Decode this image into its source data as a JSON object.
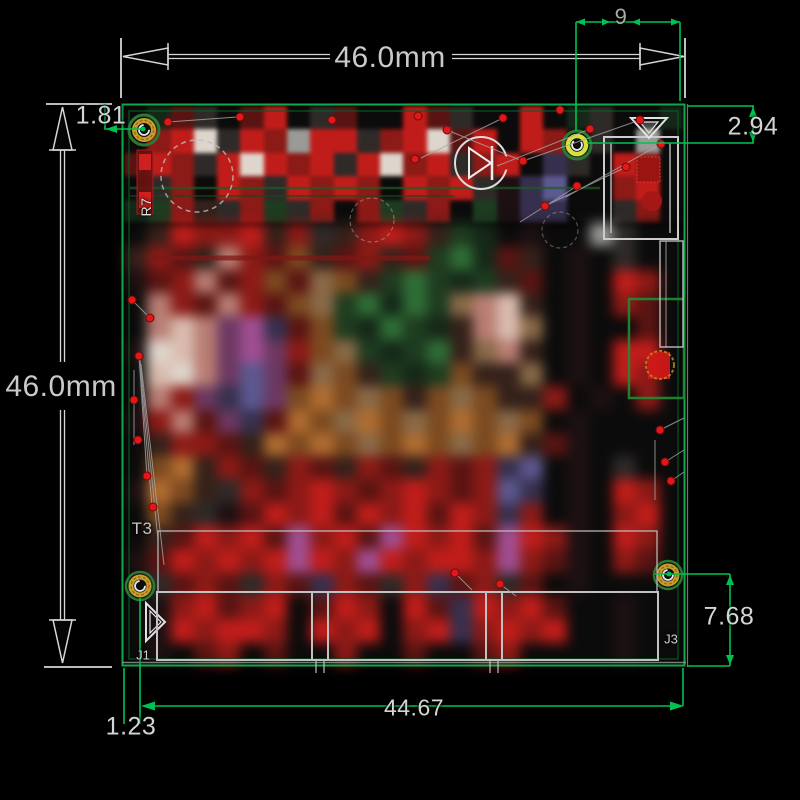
{
  "drawing": {
    "dim_top_width": "46.0mm",
    "dim_left_height": "46.0mm",
    "dim_hole_offset_top_left": "1.81",
    "dim_edge_span_top_right": "9",
    "dim_hole_offset_top_right": "2.94",
    "dim_hole_offset_bottom_right": "7.68",
    "dim_hole_span_bottom": "44.67",
    "dim_hole_offset_bottom_left": "1.23"
  },
  "silkscreen": {
    "r7": "R7",
    "t3": "T3",
    "j1": "J1",
    "j3": "J3"
  },
  "colors": {
    "dimension_green": "#00c253",
    "board_outline_green": "#0da94a",
    "dimension_white": "#d6d6d6",
    "ratsnest_red": "#e21717",
    "hole_gold": "#c79d2c",
    "hole_gold_bright": "#d3e23c"
  },
  "pcb_mosaic": {
    "palette": {
      "k": "#0b0b0b",
      "K": "#2e2a28",
      "w": "#9a9a96",
      "W": "#ded6cc",
      "r": "#591412",
      "R": "#c01d1a",
      "q": "#8c1a16",
      "o": "#7c4a20",
      "O": "#b06c30",
      "t": "#8a6a48",
      "d": "#34211a",
      "p": "#b97e74",
      "P": "#d9bcae",
      "g": "#1e3c20",
      "G": "#2f6e36",
      "e": "#152818",
      "m": "#6c3862",
      "M": "#a04e92",
      "b": "#36304e",
      "B": "#5c5890",
      "x": "#1c1012"
    },
    "rows": [
      "kerKkrRkKrkkRrKkkRkeKkke",
      "kqRWKRqwRRKqRWrRkRqkKkwk",
      "rRqKRWRqRKRWqRKqRkbKkRqk",
      "kKqkRqKRqRqkRqRKxbBkkqRk",
      "egqdKqgKqkqgKqkgxbbkkKqk",
      "kdRqqRdqKdqRqdgekxkkwKkk",
      "dqrdpqrodrqdrgGerdkxkKkk",
      "xrqprqortodgGgegdrkxkRqk",
      "kpqrpqrotgGeGgtpPdkxkqrk",
      "kpPpmMbrogeGgedpPtkxkkrk",
      "xWPpmMmqotgegGdtpdkxkRRk",
      "kPWpmBmrtodgegoddtkxkRqk",
      "kpqmbBmoOotodotoddqkxkqk",
      "xqprmbrOotOotoOotokxkkkk",
      "kdqqrdOoOotoOotoOdrxkkkk",
      "koOdqrdqrdqrdqrqbBkxkKkk",
      "xOodKqrqRqrqRqrqBbkxkRqk",
      "kodKxrRqRrRqRrRqbqkxkqRk",
      "kdrRqRrMqRrMRqRrMRqxkRqk",
      "xrRqRqRMRqMRqRRqMqrxkqrk",
      "kKrqrKqrbqrKqbrqKrkxkkkk",
      "kxqRrqRkrRqkRrbRqRrkkxkk",
      "kxRqRRqkRqRkqRbqRqRkkxkk",
      "kxkrqkrkkqkkrkkrqkkkkxkk"
    ]
  }
}
